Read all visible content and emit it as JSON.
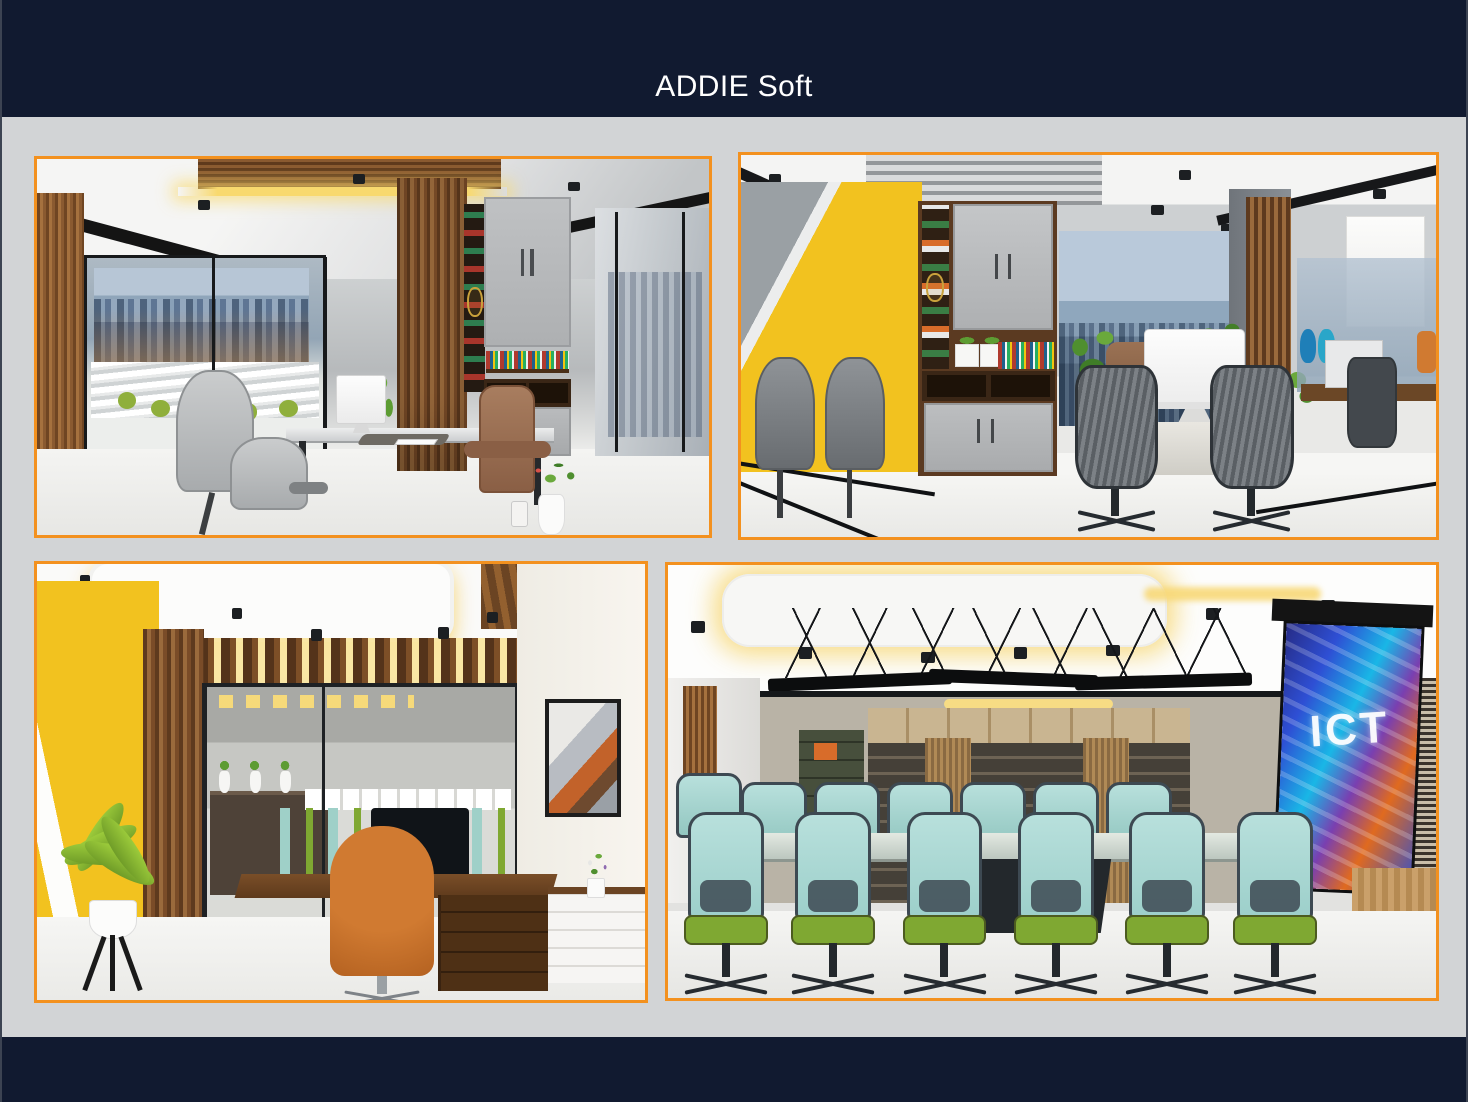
{
  "header": {
    "title": "ADDIE Soft"
  },
  "theme": {
    "header_bg": "#111a30",
    "footer_bg": "#111a30",
    "page_bg": "#d2d4d6",
    "panel_border": "#f3911f",
    "accent_yellow": "#f2c21f"
  },
  "gallery": {
    "panels": [
      {
        "name": "open-plan-office-render"
      },
      {
        "name": "yellow-accent-workspace-render"
      },
      {
        "name": "executive-office-render"
      },
      {
        "name": "conference-room-render"
      }
    ],
    "projection_screen_text": "ICT"
  }
}
